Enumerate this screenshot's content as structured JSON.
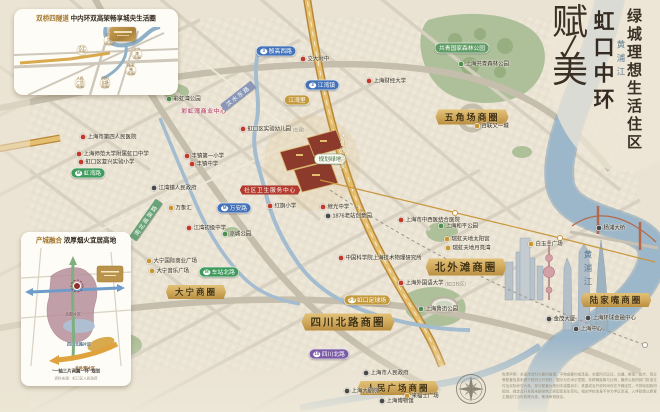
{
  "title_block": {
    "brand_char_top": "赋",
    "brand_char_bottom": "美",
    "location": "虹口中环",
    "tagline": "绿城理想生活住区"
  },
  "inset_traffic": {
    "title_prefix": "双桥四隧道",
    "title_rest": "中内环双高架畅享城央生活圈",
    "bubbles": [
      {
        "text": "大宁\n商圈",
        "x": 68,
        "y": 41
      },
      {
        "text": "五角场\n商圈",
        "x": 95,
        "y": 31
      },
      {
        "text": "北外滩\n商圈",
        "x": 123,
        "y": 45
      },
      {
        "text": "陆家嘴\n商圈",
        "x": 117,
        "y": 61
      },
      {
        "text": "人民广场\n商圈",
        "x": 66,
        "y": 74
      },
      {
        "text": "四川北路\n商圈",
        "x": 91,
        "y": 74
      }
    ],
    "project_card": {
      "x": 96,
      "y": 18,
      "w": 26,
      "h": 14
    }
  },
  "inset_planning": {
    "title_prefix": "产城融合",
    "title_rest": "浓厚烟火宜居高地",
    "area_labels": [
      {
        "text": "北部片区",
        "x": 52,
        "y": 82,
        "color": "#7d5560"
      },
      {
        "text": "四川北路片区",
        "x": 58,
        "y": 112,
        "color": "#4a6b85"
      },
      {
        "text": "北外滩片区",
        "x": 64,
        "y": 136,
        "color": "#8a5a1f"
      }
    ],
    "caption": "“一轴三片两翼一环”规划",
    "source": "资料来源：虹口区人民政府"
  },
  "map": {
    "ribbons": [
      {
        "text": "五角场商圈",
        "x": 472,
        "y": 117,
        "fs": 9
      },
      {
        "text": "北外滩商圈",
        "x": 466,
        "y": 267,
        "fs": 10.5
      },
      {
        "text": "陆家嘴商圈",
        "x": 616,
        "y": 300,
        "fs": 8.5
      },
      {
        "text": "四川北路商圈",
        "x": 348,
        "y": 322,
        "fs": 10.5
      },
      {
        "text": "人民广场商圈",
        "x": 398,
        "y": 388,
        "fs": 8.5
      },
      {
        "text": "大宁商圈",
        "x": 196,
        "y": 292,
        "fs": 8.5
      }
    ],
    "stations": [
      {
        "label": "殷高西路",
        "x": 276,
        "y": 51,
        "line": "3",
        "color": "blue"
      },
      {
        "label": "江湾镇",
        "x": 322,
        "y": 85,
        "line": "3",
        "color": "blue"
      },
      {
        "label": "江湾里",
        "x": 297,
        "y": 100,
        "line": "",
        "color": "gold"
      },
      {
        "label": "万安路",
        "x": 234,
        "y": 208,
        "line": "M",
        "color": "blue"
      },
      {
        "label": "虹湾路",
        "x": 88,
        "y": 173,
        "line": "M",
        "color": "green"
      },
      {
        "label": "车站北路",
        "x": 219,
        "y": 272,
        "line": "M",
        "color": "green"
      },
      {
        "label": "虹口足球场",
        "x": 367,
        "y": 300,
        "line": "3·8",
        "color": "gold"
      },
      {
        "label": "四川北路",
        "x": 329,
        "y": 354,
        "line": "10",
        "color": "purple"
      }
    ],
    "pois": [
      {
        "text": "彩虹湾公园",
        "x": 166,
        "y": 99,
        "type": "park"
      },
      {
        "text": "上海共青森林公园",
        "x": 458,
        "y": 64,
        "type": "park"
      },
      {
        "text": "上海和平公园",
        "x": 438,
        "y": 226,
        "type": "park"
      },
      {
        "text": "上海鲁迅公园",
        "x": 418,
        "y": 309,
        "type": "park"
      },
      {
        "text": "凉城公园",
        "x": 222,
        "y": 234,
        "type": "park"
      },
      {
        "text": "交大附中",
        "x": 300,
        "y": 59,
        "type": "school"
      },
      {
        "text": "上海财经大学",
        "x": 366,
        "y": 81,
        "type": "school"
      },
      {
        "text": "上海市第四人民医院",
        "x": 80,
        "y": 137,
        "type": "school"
      },
      {
        "text": "上海师范大学附属虹口中学",
        "x": 76,
        "y": 154,
        "type": "school"
      },
      {
        "text": "虹口区复兴实验小学",
        "x": 78,
        "y": 162,
        "type": "school"
      },
      {
        "text": "丰镇第一小学",
        "x": 184,
        "y": 156,
        "type": "school"
      },
      {
        "text": "丰镇中学",
        "x": 189,
        "y": 164,
        "type": "school"
      },
      {
        "text": "虹口区实验幼儿园",
        "x": 240,
        "y": 129,
        "type": "school",
        "suffix": "(在建)"
      },
      {
        "text": "江湾初级中学",
        "x": 186,
        "y": 228,
        "type": "school"
      },
      {
        "text": "红旗小学",
        "x": 267,
        "y": 206,
        "type": "school"
      },
      {
        "text": "继光中学",
        "x": 320,
        "y": 207,
        "type": "school"
      },
      {
        "text": "上海外国语大学",
        "x": 398,
        "y": 283,
        "type": "school",
        "suffix": "(虹口校区)"
      },
      {
        "text": "上海市中西医结合医院",
        "x": 398,
        "y": 220,
        "type": "school"
      },
      {
        "text": "中国科学院上海技术物理研究所",
        "x": 338,
        "y": 258,
        "type": "school"
      },
      {
        "text": "万象汇",
        "x": 168,
        "y": 208,
        "type": "mall"
      },
      {
        "text": "瑞虹天地太阳宫",
        "x": 444,
        "y": 239,
        "type": "mall"
      },
      {
        "text": "瑞虹天地月亮湾",
        "x": 445,
        "y": 248,
        "type": "mall"
      },
      {
        "text": "白玉兰广场",
        "x": 528,
        "y": 244,
        "type": "mall"
      },
      {
        "text": "百联又一城",
        "x": 474,
        "y": 126,
        "type": "mall"
      },
      {
        "text": "大宁国际商业广场",
        "x": 146,
        "y": 261,
        "type": "mall"
      },
      {
        "text": "大宁音乐广场",
        "x": 149,
        "y": 271,
        "type": "mall"
      },
      {
        "text": "来福士广场",
        "x": 404,
        "y": 396,
        "type": "mall"
      },
      {
        "text": "江湾镇人民政府",
        "x": 151,
        "y": 188,
        "type": "civic"
      },
      {
        "text": "1876老站创意园",
        "x": 325,
        "y": 216,
        "type": "civic"
      },
      {
        "text": "上海市人民政府",
        "x": 363,
        "y": 373,
        "type": "civic"
      },
      {
        "text": "上海大剧院",
        "x": 344,
        "y": 391,
        "type": "civic"
      },
      {
        "text": "上海博物馆",
        "x": 379,
        "y": 401,
        "type": "civic"
      },
      {
        "text": "金茂大厦",
        "x": 546,
        "y": 319,
        "type": "landmark"
      },
      {
        "text": "上海中心",
        "x": 573,
        "y": 329,
        "type": "landmark"
      },
      {
        "text": "上海环球金融中心",
        "x": 585,
        "y": 318,
        "type": "landmark"
      },
      {
        "text": "杨浦大桥",
        "x": 596,
        "y": 228,
        "type": "landmark"
      }
    ],
    "tags": [
      {
        "text": "社区卫生服务中心",
        "x": 270,
        "y": 190,
        "style": "red"
      },
      {
        "text": "彩虹湾商业中心",
        "x": 204,
        "y": 111,
        "style": "pink"
      },
      {
        "text": "规划绿地",
        "x": 330,
        "y": 159,
        "style": "white"
      },
      {
        "text": "共青国家森林公园",
        "x": 462,
        "y": 48,
        "style": "green"
      }
    ],
    "road_banners": [
      {
        "text": "汶水东路",
        "x": 238,
        "y": 96,
        "rot": -38,
        "bg": "#8a97b8"
      },
      {
        "text": "南北高架路",
        "x": 146,
        "y": 220,
        "rot": -55,
        "bg": "#69a377"
      }
    ],
    "onroad_labels": [
      {
        "text": "逸仙路高架",
        "x": 343,
        "y": 128
      }
    ],
    "river_labels": [
      {
        "text": "黄浦江",
        "x": 621,
        "y": 40
      },
      {
        "text": "黄浦江",
        "x": 588,
        "y": 250
      }
    ]
  },
  "footer": {
    "disclaimer": "免责声明：本宣传资料为要约邀请，不构成要约或承诺。本图所示区位、交通、教育、医疗、商业等配套信息来源于政府公开资料，图示为艺术示意图，非精确距离与比例，最终以政府部门批准文件及实际状况为准。部分配套为规划中或建设中，其建成及开放时间存在不确定性，不排除因政府规划、规定及开发商未能控制之原因而发生变化。相关学校信息不作为学区承诺，入学政策以教育主管部门当年政策为准。敬请审慎核实。"
  },
  "colors": {
    "gold1": "#e2c277",
    "gold2": "#cfa75a",
    "gold3": "#b98e40",
    "red": "#b23a2e",
    "metro": {
      "blue": "#4472b8",
      "green": "#3e9b5c",
      "purple": "#7b5aa6",
      "gold": "#c49a3f"
    },
    "poi_dots": {
      "school": "#c0392b",
      "park": "#4e8f4e",
      "mall": "#c9972f",
      "civic": "#4a4a4a",
      "landmark": "#4a4a4a"
    }
  }
}
